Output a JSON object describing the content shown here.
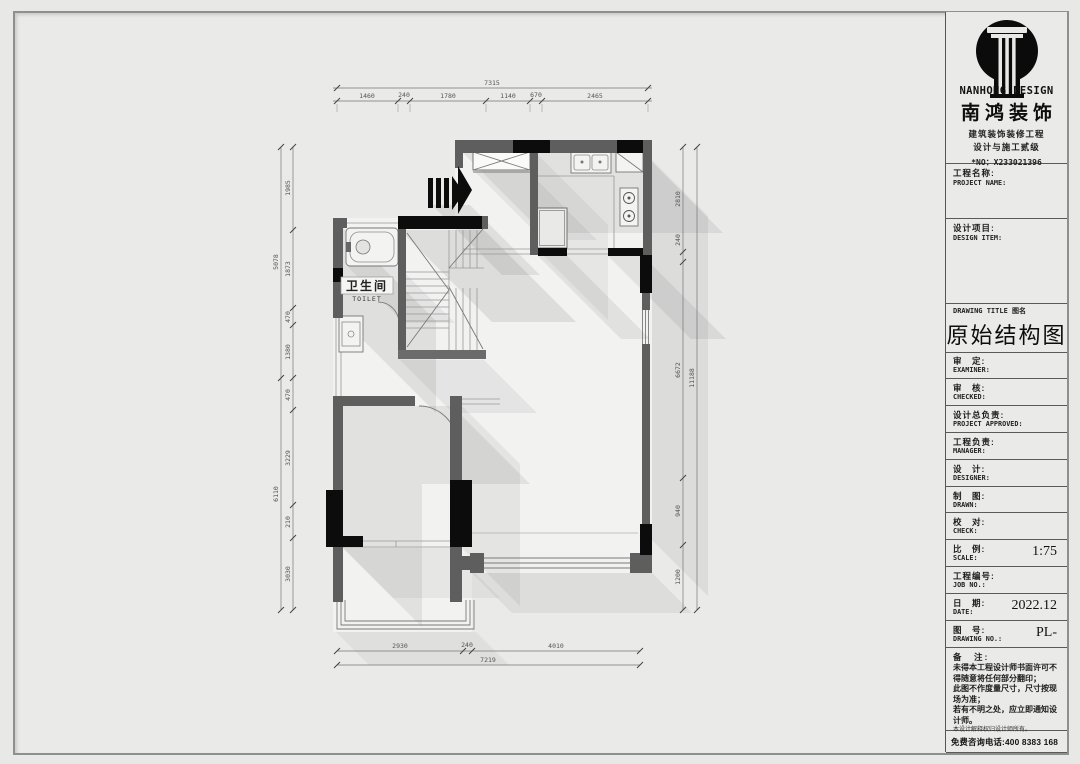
{
  "colors": {
    "paper": "#e8e8e7",
    "wall_gray": "#5e5e5e",
    "column_black": "#0c0c0c"
  },
  "brand": {
    "name_en": "NANHONG DESIGN",
    "name_cn": "南鸿装饰",
    "cert1": "建筑装饰装修工程",
    "cert2": "设计与施工贰级",
    "license_no": "*NO：X233021396"
  },
  "title_block": {
    "project_name": {
      "cn": "工程名称:",
      "en": "PROJECT NAME:"
    },
    "design_item": {
      "cn": "设计项目:",
      "en": "DESIGN ITEM:"
    },
    "drawing_title_label": "DRAWING TITLE 图名",
    "drawing_title": "原始结构图",
    "rows": [
      {
        "cn": "审　定:",
        "en": "EXAMINER:",
        "value": ""
      },
      {
        "cn": "审　核:",
        "en": "CHECKED:",
        "value": ""
      },
      {
        "cn": "设计总负责:",
        "en": "PROJECT APPROVED:",
        "value": ""
      },
      {
        "cn": "工程负责:",
        "en": "MANAGER:",
        "value": ""
      },
      {
        "cn": "设　计:",
        "en": "DESIGNER:",
        "value": ""
      },
      {
        "cn": "制　图:",
        "en": "DRAWN:",
        "value": ""
      },
      {
        "cn": "校　对:",
        "en": "CHECK:",
        "value": ""
      },
      {
        "cn": "比　例:",
        "en": "SCALE:",
        "value": "1:75"
      },
      {
        "cn": "工程编号:",
        "en": "JOB NO.:",
        "value": ""
      },
      {
        "cn": "日　期:",
        "en": "DATE:",
        "value": "2022.12"
      },
      {
        "cn": "图　号:",
        "en": "DRAWING NO.:",
        "value": "PL-"
      }
    ],
    "notes_title": "备　注:",
    "notes": [
      "未得本工程设计师书面许可不得随意将任何部分翻印；",
      "此图不作度量尺寸，尺寸按现场为准；",
      "若有不明之处，应立即通知设计师。"
    ],
    "notes_fine": "本设计解释权归设计师所有。",
    "hotline": "免费咨询电话:400 8383 168"
  },
  "plan": {
    "room": {
      "cn": "卫生间",
      "en": "TOILET"
    },
    "dims": {
      "top_overall": "7315",
      "top_segments": [
        "1460",
        "240",
        "1780",
        "1140",
        "670",
        "2465"
      ],
      "bottom_segments": [
        "2930",
        "240",
        "4010"
      ],
      "bottom_overall": "7219",
      "left_outer": [
        "5078",
        "6110"
      ],
      "left_segments": [
        "1985",
        "1873",
        "470",
        "1380",
        "470",
        "3229",
        "210",
        "3030"
      ],
      "right_segments": [
        "2810",
        "240",
        "6672",
        "940",
        "1200"
      ],
      "right_overall": "11188"
    }
  }
}
